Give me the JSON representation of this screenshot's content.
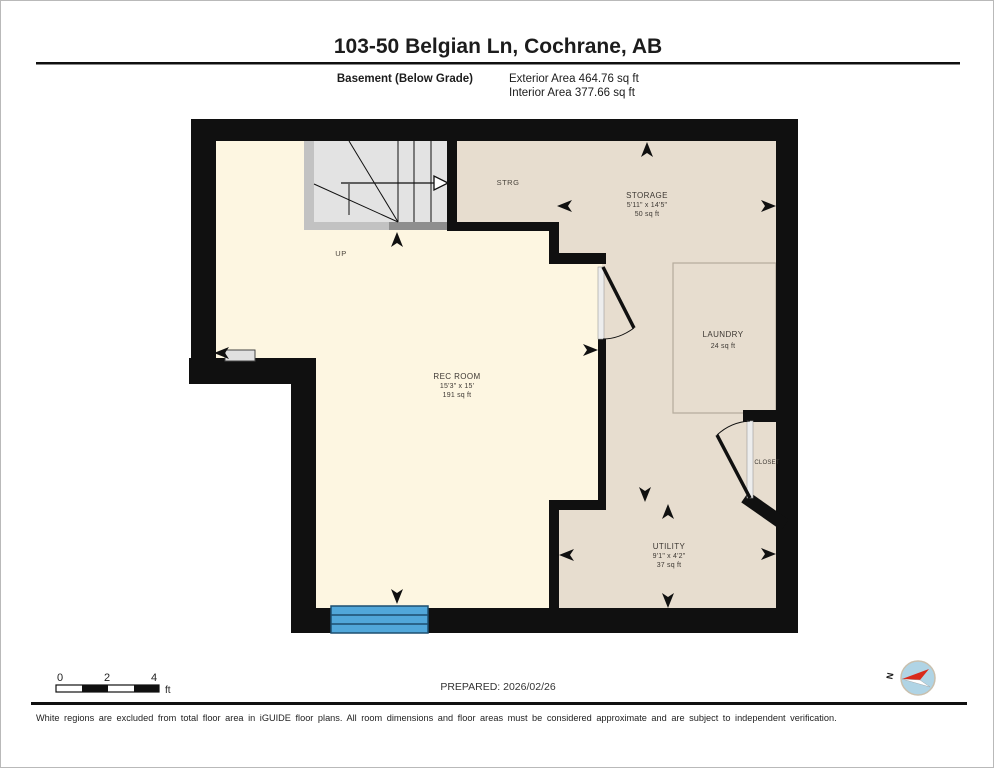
{
  "header": {
    "title": "103-50 Belgian Ln, Cochrane, AB",
    "floor_label": "Basement (Below Grade)",
    "exterior_area": "Exterior Area 464.76 sq ft",
    "interior_area": "Interior Area 377.66 sq ft"
  },
  "rooms": {
    "rec_room": {
      "name": "REC ROOM",
      "dims": "15'3\" x 15'",
      "area": "191 sq ft"
    },
    "storage": {
      "name": "STORAGE",
      "dims": "5'11\" x 14'5\"",
      "area": "50 sq ft"
    },
    "strg": {
      "name": "STRG"
    },
    "laundry": {
      "name": "LAUNDRY",
      "area": "24 sq ft"
    },
    "utility": {
      "name": "UTILITY",
      "dims": "9'1\" x 4'2\"",
      "area": "37 sq ft"
    },
    "closet": {
      "name": "CLOSET"
    },
    "stairs": {
      "label": "UP"
    }
  },
  "scale_bar": {
    "ticks": [
      "0",
      "2",
      "4"
    ],
    "unit": "ft"
  },
  "compass": {
    "north_label": "N"
  },
  "footer": {
    "prepared": "PREPARED: 2026/02/26",
    "disclaimer": "White regions are excluded from total floor area in iGUIDE floor plans. All room dimensions and floor areas must be considered approximate and are subject to independent verification."
  },
  "colors": {
    "interior_included": "#fdf6e1",
    "interior_excluded": "#e7ddcf",
    "wall": "#101010",
    "window_blue": "#51a7da",
    "compass_blue": "#b0d4e5",
    "compass_red": "#d92b1c"
  }
}
